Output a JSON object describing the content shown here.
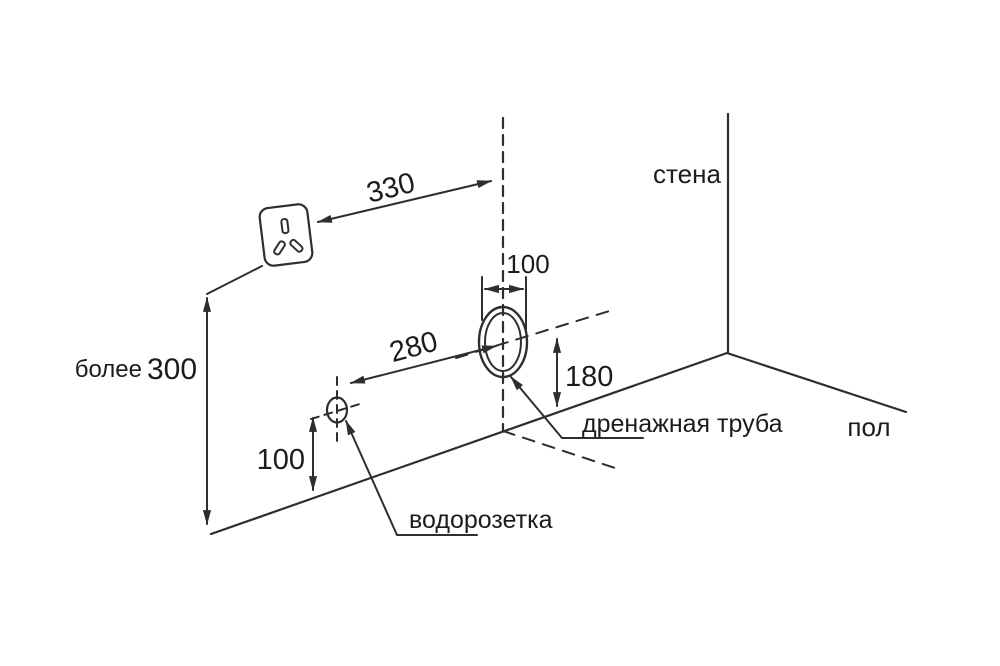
{
  "colors": {
    "line": "#2e2e2e",
    "text": "#1c1c1c",
    "background": "#ffffff"
  },
  "labels": {
    "wall": "стена",
    "floor": "пол",
    "drain_pipe": "дренажная труба",
    "water_socket": "водорозетка"
  },
  "dimensions": {
    "socket_to_axis": "330",
    "pipe_hole_width": "100",
    "axis_to_water_socket": "280",
    "drain_height": "180",
    "water_socket_height": "100",
    "min_clearance_prefix": "более",
    "min_clearance_value": "300"
  },
  "icons": {
    "power_socket": "three-slot-power-socket"
  }
}
